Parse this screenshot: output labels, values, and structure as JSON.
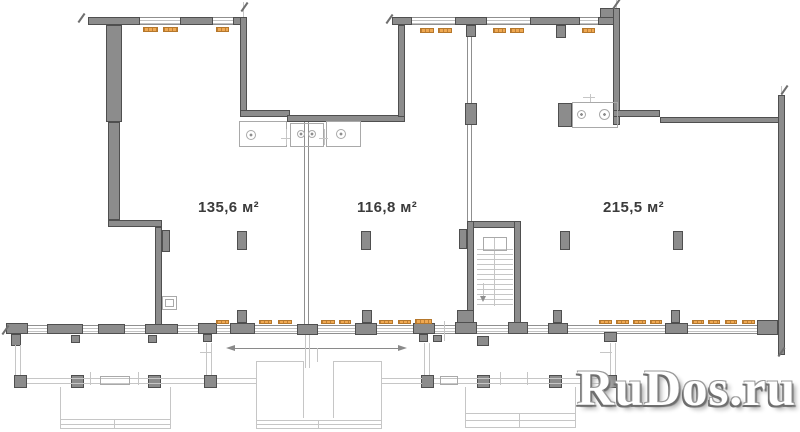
{
  "plan": {
    "rooms": [
      {
        "area_label": "135,6 м²"
      },
      {
        "area_label": "116,8 м²"
      },
      {
        "area_label": "215,5 м²"
      }
    ]
  },
  "watermark": {
    "text": "RuDos.ru"
  },
  "colors": {
    "bg": "#ffffff",
    "wall": "#8c8c8c",
    "wall_edge": "#4f4f4f",
    "window_line": "#c2c2c2",
    "window_edge": "#8f8f8f",
    "radiator": "#efa851",
    "radiator_edge": "#b5772b",
    "light_line": "#c6c6c6",
    "fixture_line": "#a9a9a9",
    "dim_line": "#8a8a8a",
    "label": "#3b3b3b",
    "watermark_fill": "#ffffff",
    "watermark_shadow": "#6e6e6e"
  }
}
